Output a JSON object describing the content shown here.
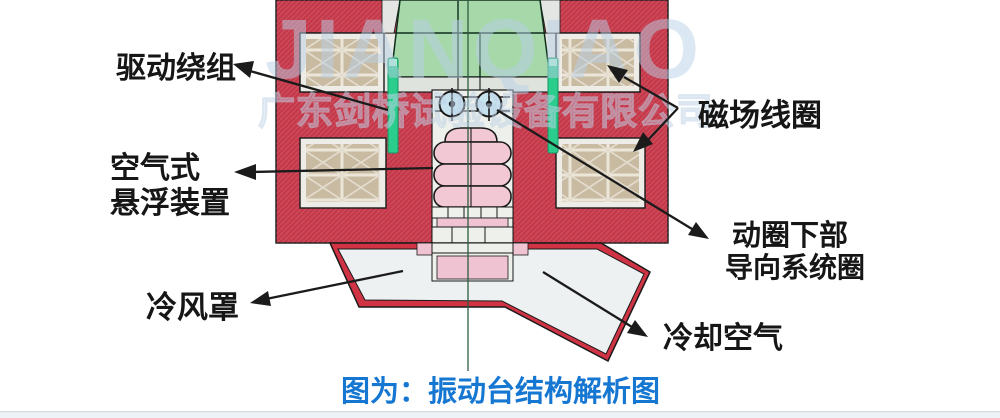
{
  "watermark": {
    "brand": "JIANQIAO",
    "company": "广东剑桥试验设备有限公司"
  },
  "caption": {
    "text": "图为：振动台结构解析图"
  },
  "labels": {
    "drive_winding": "驱动绕组",
    "air_suspension_line1": "空气式",
    "air_suspension_line2": "悬浮装置",
    "cold_air_hood": "冷风罩",
    "field_coil": "磁场线圈",
    "guide_coil_line1": "动圈下部",
    "guide_coil_line2": "导向系统圈",
    "cooling_air": "冷却空气"
  },
  "colors": {
    "body_red": "#c5394a",
    "hood_red": "#cf3344",
    "armature_green": "#a6d8aa",
    "winding_green": "#2bcd8d",
    "coil_tan": "#c9bba2",
    "roller_blue": "#c6e2ee",
    "bellows_pink": "#f3c8d5",
    "support_pink": "#f0c3d2",
    "caption_blue": "#1677d2",
    "watermark_blue": "#b9d0e6"
  }
}
